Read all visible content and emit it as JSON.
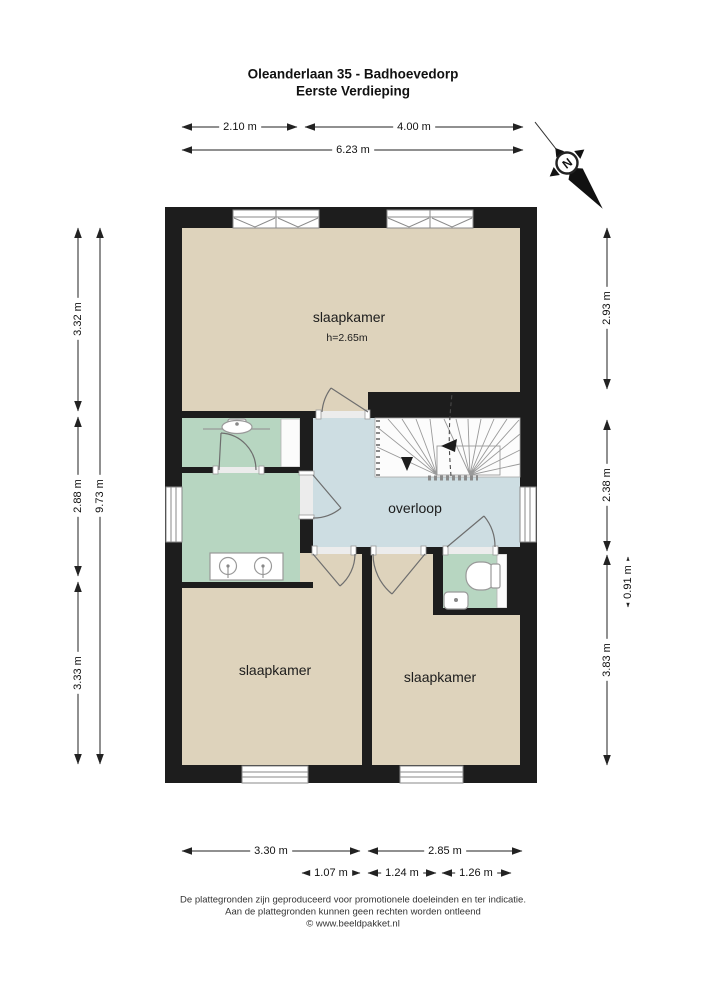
{
  "title": {
    "line1": "Oleanderlaan 35 - Badhoevedorp",
    "line2": "Eerste Verdieping"
  },
  "rooms": {
    "slaapkamer_top": {
      "label": "slaapkamer",
      "height_note": "h=2.65m"
    },
    "overloop": {
      "label": "overloop"
    },
    "slaapkamer_left": {
      "label": "slaapkamer"
    },
    "slaapkamer_right": {
      "label": "slaapkamer"
    }
  },
  "dimensions": {
    "d210": "2.10 m",
    "d400": "4.00 m",
    "d623": "6.23 m",
    "d332": "3.32 m",
    "d288": "2.88 m",
    "d333": "3.33 m",
    "d973": "9.73 m",
    "d293": "2.93 m",
    "d238": "2.38 m",
    "d091": "0.91 m",
    "d383": "3.83 m",
    "d330": "3.30 m",
    "d285": "2.85 m",
    "d107": "1.07 m",
    "d124": "1.24 m",
    "d126": "1.26 m"
  },
  "compass": {
    "north_label": "N"
  },
  "footer": {
    "line1": "De plattegronden zijn geproduceerd voor promotionele doeleinden en ter indicatie.",
    "line2": "Aan de plattegronden kunnen geen rechten worden ontleend",
    "line3": "© www.beeldpakket.nl"
  },
  "colors": {
    "wall": "#1d1d1d",
    "room_beige": "#ded3bc",
    "room_green": "#b7d6c1",
    "room_blue": "#cddde2",
    "dimension": "#222222"
  }
}
